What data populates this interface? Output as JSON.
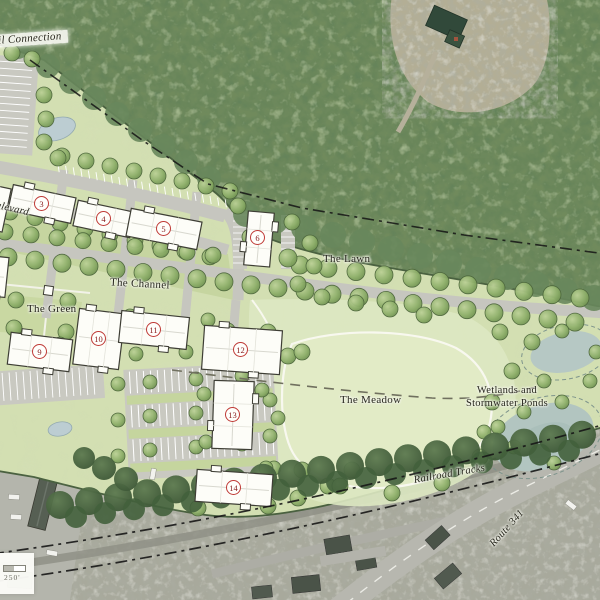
{
  "map": {
    "labels": {
      "trail_connection": "Trail Connection",
      "boulevard": "Boulevard",
      "the_channel": "The Channel",
      "the_lawn": "The Lawn",
      "the_green": "The Green",
      "the_meadow": "The Meadow",
      "wetlands_line1": "Wetlands and",
      "wetlands_line2": "Stormwater Ponds",
      "railroad_tracks": "Railroad Tracks",
      "route_341": "Route 341"
    },
    "scale_bar": {
      "label": "250'"
    },
    "building_markers": [
      {
        "label": "3",
        "x": 42,
        "y": 204
      },
      {
        "label": "4",
        "x": 104,
        "y": 219
      },
      {
        "label": "5",
        "x": 164,
        "y": 229
      },
      {
        "label": "6",
        "x": 258,
        "y": 238
      },
      {
        "label": "9",
        "x": 40,
        "y": 352
      },
      {
        "label": "10",
        "x": 99,
        "y": 339
      },
      {
        "label": "11",
        "x": 154,
        "y": 330
      },
      {
        "label": "12",
        "x": 241,
        "y": 350
      },
      {
        "label": "13",
        "x": 233,
        "y": 415
      },
      {
        "label": "14",
        "x": 234,
        "y": 488
      }
    ],
    "colors": {
      "marker_red": "#bf3a36",
      "plan_green": "#d3dfb2",
      "forest_green": "#6f8a5c",
      "road_gray": "#c5c5bd",
      "pond_blue": "#bccdd2"
    }
  }
}
